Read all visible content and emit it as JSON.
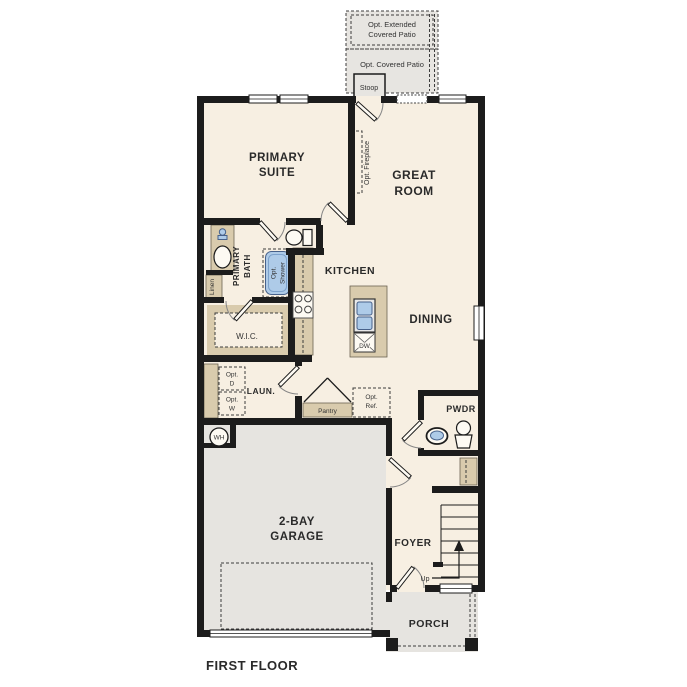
{
  "title": "FIRST FLOOR",
  "colors": {
    "floor": "#f7efe2",
    "wall": "#1c1c1c",
    "patio_gray": "#e7e5e1",
    "garage_gray": "#e6e4e0",
    "cabinet_tan": "#d9cbad",
    "fixture_blue": "#aecbe8"
  },
  "rooms": {
    "primary_suite": [
      "PRIMARY",
      "SUITE"
    ],
    "great_room": [
      "GREAT",
      "ROOM"
    ],
    "kitchen": "KITCHEN",
    "dining": "DINING",
    "primary_bath": [
      "PRIMARY",
      "BATH"
    ],
    "wic": "W.I.C.",
    "laundry": "LAUN.",
    "powder": "PWDR",
    "garage": [
      "2-BAY",
      "GARAGE"
    ],
    "foyer": "FOYER",
    "porch": "PORCH"
  },
  "annotations": {
    "opt_extended_patio": [
      "Opt. Extended",
      "Covered Patio"
    ],
    "opt_covered_patio": "Opt. Covered Patio",
    "stoop": "Stoop",
    "opt_fireplace": "Opt. Fireplace",
    "linen": "Linen",
    "opt_shower": [
      "Opt.",
      "Shower"
    ],
    "opt_dryer": [
      "Opt.",
      "D"
    ],
    "opt_washer": [
      "Opt.",
      "W"
    ],
    "pantry": "Pantry",
    "opt_ref": [
      "Opt.",
      "Ref."
    ],
    "water_heater": "WH",
    "dishwasher": "DW",
    "stairs_up": "Up"
  }
}
